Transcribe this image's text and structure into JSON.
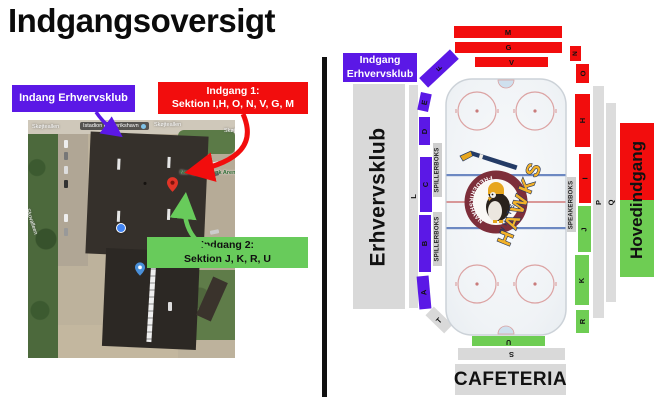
{
  "title": "Indgangsoversigt",
  "map": {
    "streets": {
      "top_left": "Skøjteallen",
      "top_mid": "Skøjteallen",
      "top_right": "Skøjteallen",
      "left_vertical": "Skovalleen"
    },
    "place_label": "Istadion Frederikshavn",
    "arena_label": "Nordjyske Bank Arena",
    "callout_purple": "Indang Erhvervsklub",
    "callout_red_line1": "Indgang 1:",
    "callout_red_line2": "Sektion I,H, O, N, V, G, M",
    "callout_green_line1": "Indgang 2:",
    "callout_green_line2": "Sektion J, K, R, U"
  },
  "arena": {
    "entrance_box_line1": "Indgang",
    "entrance_box_line2": "Erhvervsklub",
    "left_stand": "Erhvervsklub",
    "main_entrance": "Hovedindgang",
    "cafeteria": "CAFETERIA",
    "spillerboks": "SPILLERBOKS",
    "speakerboks": "SPEAKERBOKS",
    "sections": {
      "M": "M",
      "G": "G",
      "V": "V",
      "N": "N",
      "F": "F",
      "E": "E",
      "D": "D",
      "C": "C",
      "B": "B",
      "A": "A",
      "L": "L",
      "T": "T",
      "O": "O",
      "H": "H",
      "I": "I",
      "J": "J",
      "K": "K",
      "R": "R",
      "P": "P",
      "Q": "Q",
      "U": "U",
      "S": "S"
    }
  },
  "logo": {
    "club_name_arc": "FREDERIKSHAVN",
    "white": "WHITE",
    "hawks": "HAWKS"
  },
  "colors": {
    "purple": "#5b18e6",
    "red": "#f20d0d",
    "green": "#6ecd53",
    "gray": "#d9d9d9",
    "logo_maroon": "#7d2e3a",
    "logo_navy": "#23355e",
    "logo_yellow": "#f3b229"
  }
}
